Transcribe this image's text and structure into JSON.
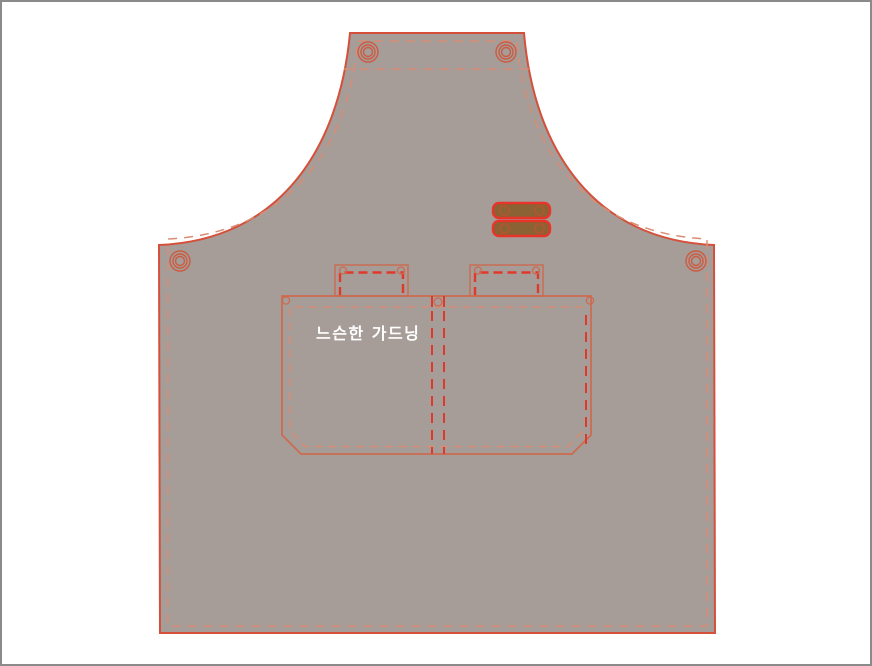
{
  "canvas": {
    "type": "apron-pattern-mockup",
    "background": "#ffffff",
    "frame_border": "#8a8a8a"
  },
  "apron": {
    "pocket_label": "느슨한 가드닝",
    "grommet_count": 4,
    "strap_count": 2,
    "tool_loop_count": 2,
    "pocket_compartments": 2
  },
  "palette": {
    "page_bg": "#ffffff",
    "frame_border": "#8a8a8a",
    "fabric": "#a69c98",
    "outline": "#d5503a",
    "stitch": "#d98d75",
    "accent": "#e2382a",
    "detail": "#cd6a4f",
    "grommet": "#cd5b41",
    "strap_fill": "#8a6233",
    "strap_border": "#e8342a",
    "label_color": "#ffffff"
  }
}
